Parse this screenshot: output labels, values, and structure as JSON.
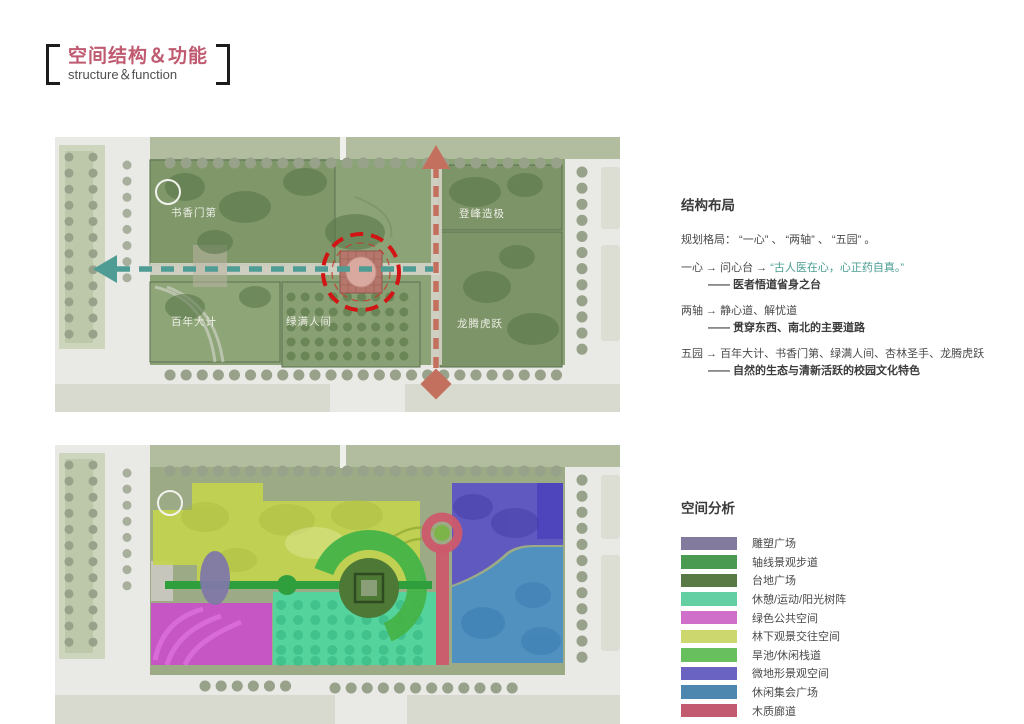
{
  "header": {
    "title_zh": "空间结构＆功能",
    "title_en": "structure＆function",
    "title_color": "#c05a70"
  },
  "structure": {
    "heading": "结构布局",
    "intro": "规划格局： “一心” 、 “两轴” 、 “五园” 。",
    "quote_color": "#4a9d92",
    "items": [
      {
        "lead": "一心 → 问心台 → ",
        "quote": "“古人医在心，心正药自真。”",
        "sub": "—— 医者悟道省身之台"
      },
      {
        "lead": "两轴 → 静心道、解忧道",
        "quote": "",
        "sub": "—— 贯穿东西、南北的主要道路"
      },
      {
        "lead": "五园 → 百年大计、书香门第、绿满人间、杏林圣手、龙腾虎跃",
        "quote": "",
        "sub": "—— 自然的生态与清新活跃的校园文化特色"
      }
    ]
  },
  "analysis": {
    "heading": "空间分析",
    "legend": [
      {
        "label": "雕塑广场",
        "color": "#837b9e"
      },
      {
        "label": "轴线景观步道",
        "color": "#4b9a51"
      },
      {
        "label": "台地广场",
        "color": "#5a7a45"
      },
      {
        "label": "休憩/运动/阳光树阵",
        "color": "#63cfa2"
      },
      {
        "label": "绿色公共空间",
        "color": "#d06fc9"
      },
      {
        "label": "林下观景交往空间",
        "color": "#ccd76d"
      },
      {
        "label": "旱池/休闲栈道",
        "color": "#67bf5e"
      },
      {
        "label": "微地形景观空间",
        "color": "#6a63c2"
      },
      {
        "label": "休闲集会广场",
        "color": "#4d87b0"
      },
      {
        "label": "木质廊道",
        "color": "#c25b70"
      }
    ]
  },
  "plans": {
    "top": {
      "labels": [
        "书香门第",
        "登峰造极",
        "百年大计",
        "绿满人间",
        "龙腾虎跃"
      ],
      "axis_ew_color": "#4e9c94",
      "axis_ns_color": "#c4705e",
      "core_ring_color": "#d21414"
    },
    "bottom": {
      "zones": {
        "sculpture_plaza": "#8078a8",
        "axis_walk": "#2f9e3c",
        "terrace_plaza": "#4e7836",
        "rest_sun_grove": "#4ed69e",
        "green_public": "#c94ec9",
        "forest_view": "#c3d24f",
        "drypool_boardwalk": "#45b348",
        "microterrain": "#5a51c6",
        "gathering_plaza": "#4b8ec6",
        "wood_corridor": "#cc5a6b"
      }
    }
  }
}
